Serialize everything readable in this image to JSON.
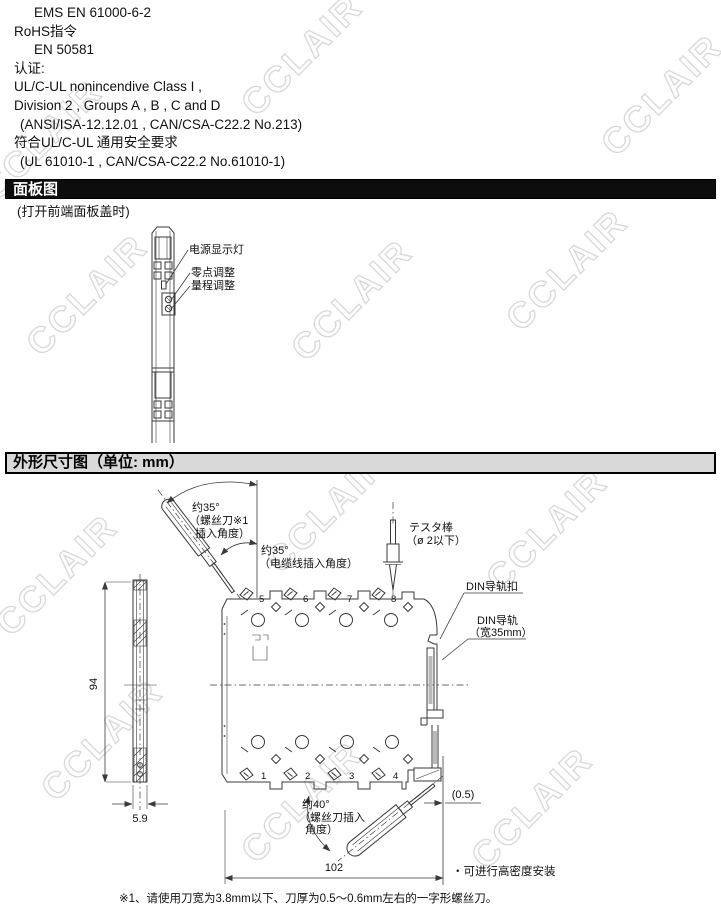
{
  "watermark": {
    "text": "CCLAIR"
  },
  "cert_lines": [
    "EMS EN 61000-6-2",
    "RoHS指令",
    "EN 50581",
    "认证:",
    "UL/C-UL nonincendive Class I ,",
    "Division 2 , Groups A , B , C and D",
    "(ANSI/ISA-12.12.01 , CAN/CSA-C22.2 No.213)",
    "符合UL/C-UL 通用安全要求",
    "(UL 61010-1 , CAN/CSA-C22.2 No.61010-1)"
  ],
  "panel": {
    "title": "面板图",
    "subtitle": "(打开前端面板盖时)",
    "label_power_led": "电源显示灯",
    "label_zero": "零点调整",
    "label_span": "量程调整"
  },
  "dims": {
    "title": "外形尺寸图（单位: mm）",
    "screwdriver_top_1": "约35°",
    "screwdriver_top_2": "（螺丝刀※1",
    "screwdriver_top_3": "插入角度）",
    "cable_1": "约35°",
    "cable_2": "（电缆线插入角度）",
    "tester_1": "テスタ棒",
    "tester_2": "（ø 2以下）",
    "din_clip": "DIN导轨扣",
    "din_rail_1": "DIN导轨",
    "din_rail_2": "（宽35mm）",
    "screwdriver_bottom_1": "约40°",
    "screwdriver_bottom_2": "（螺丝刀插入",
    "screwdriver_bottom_3": "角度）",
    "high_density_note": "・可进行高密度安装",
    "dim_height": "94",
    "dim_depth": "5.9",
    "dim_width": "102",
    "dim_gap": "(0.5)",
    "terminals_top": [
      "5",
      "6",
      "7",
      "8"
    ],
    "terminals_bottom": [
      "1",
      "2",
      "3",
      "4"
    ]
  },
  "footnote": "※1、请使用刀宽为3.8mm以下、刀厚为0.5～0.6mm左右的一字形螺丝刀。"
}
